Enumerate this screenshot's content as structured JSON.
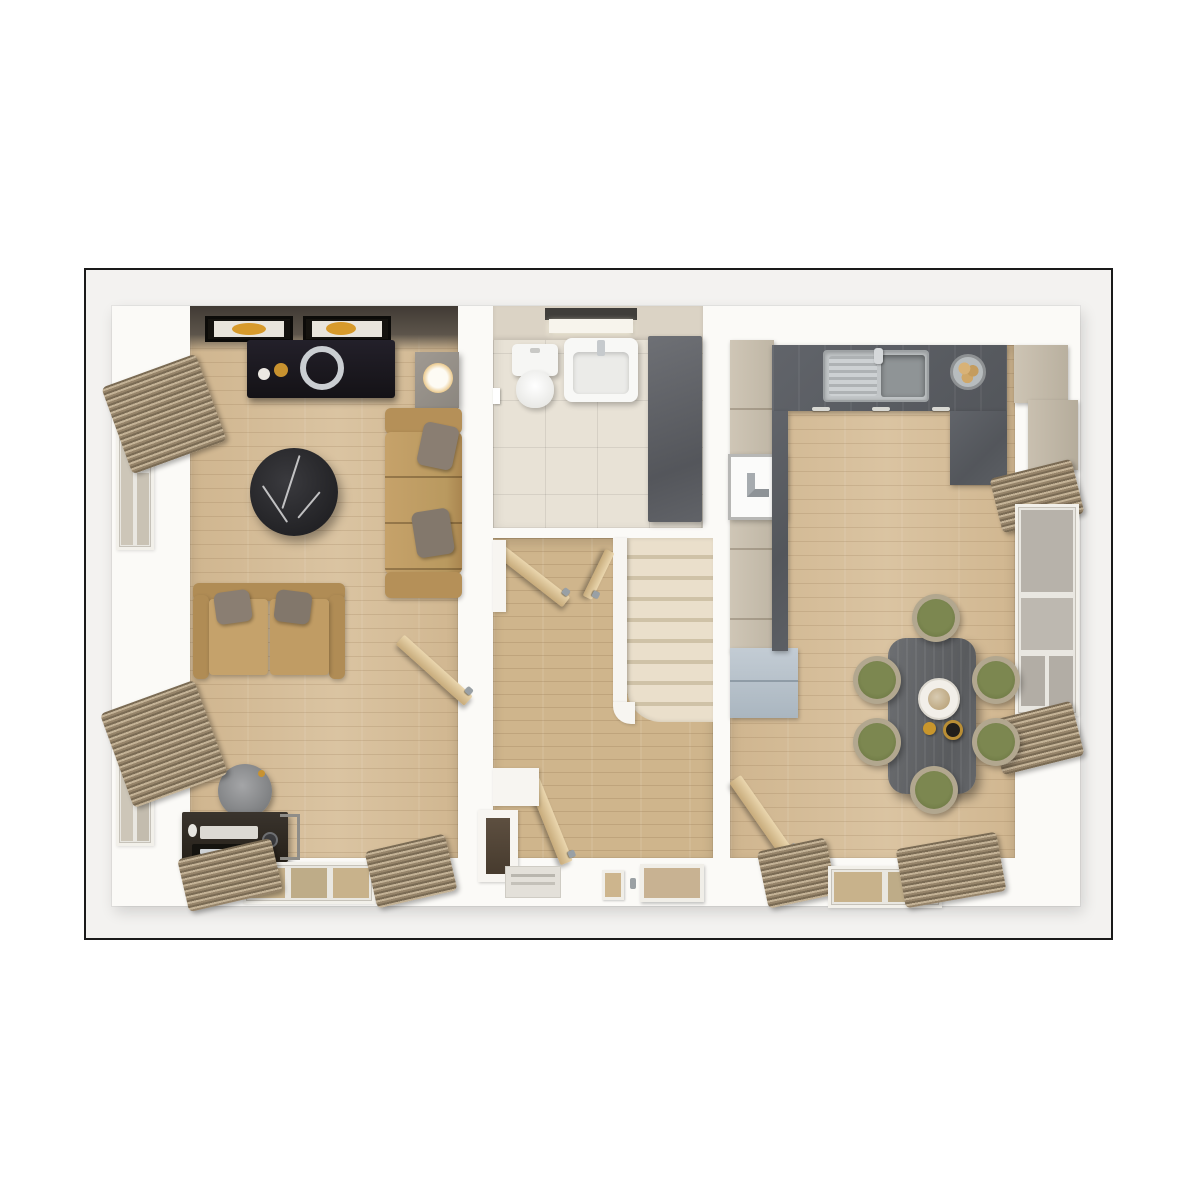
{
  "scene": {
    "type": "3d-floor-plan-render",
    "description": "Top-down 3D render of a ground floor: living room (left), WC (top centre), hallway with staircase and front door (centre), kitchen and dining room (right)",
    "background": "#ffffff",
    "frame": {
      "border_color": "#1a1a1a",
      "inner_background": "#f3f2f0"
    }
  },
  "palette": {
    "wall_white": "#fbfaf7",
    "living_wood_floor": "#d6bd97",
    "hall_wood_floor": "#cfb58c",
    "bathroom_tile_cream": "#e8e2d6",
    "worktop_dark_gray": "#5a5d62",
    "cabinet_beige": "#c9c0b0",
    "cabinet_blue_gray": "#b5c0c9",
    "sofa_tan": "#c19e67",
    "pillow_gray": "#8a7e72",
    "coffee_table_black_marble": "#2c2c2f",
    "dining_table_gray_wood": "#63666a",
    "chair_olive_green": "#717c46",
    "chair_shell_beige": "#b2a78f",
    "blinds_brown": "#96846a",
    "door_wood_tan": "#d9c096",
    "shower_panel_gray": "#64666b",
    "stair_tread_cream": "#eadfcb",
    "lamp_glow_amber": "#d9a84f",
    "art_accent_gold": "#c8922f",
    "sink_stainless": "#c2c6c8",
    "dark_feature_wall": "#46403a"
  },
  "rooms": {
    "living_room": {
      "name": "Living Room",
      "furniture": [
        "two framed gold-art pictures",
        "dark media console with silver ring decor",
        "cube lamp",
        "corner sofa with gray cushions",
        "two-seat sofa",
        "round black marble coffee table",
        "dark desk with monitor, laptop, mouse and camera",
        "round gray desk chair",
        "two side windows with gathered venetian blinds",
        "bottom window with blinds",
        "open interior door"
      ]
    },
    "bathroom": {
      "name": "WC / Cloakroom",
      "furniture": [
        "toilet with cistern",
        "wall-hung wash basin",
        "ceiling light bar",
        "dark glass shower panel",
        "cream tiled floor",
        "door handle"
      ]
    },
    "hallway": {
      "name": "Hallway",
      "furniture": [
        "staircase with cream treads",
        "front door with two glazed panels",
        "entry step mat",
        "under-stair cupboard",
        "three open wooden doors"
      ]
    },
    "kitchen_dining": {
      "name": "Kitchen / Dining Room",
      "furniture": [
        "L-shaped dark worktop",
        "stainless sink with drainer and tap",
        "fruit bowl",
        "built-in white hob",
        "tall beige cabinet run",
        "blue-gray base cabinet",
        "staggered beige wall cabinets",
        "dark rectangular dining table",
        "six olive-green shell chairs",
        "plate with food, gold candle and dark jar",
        "right window with blinds",
        "bottom window with blinds",
        "open wooden door"
      ]
    }
  }
}
